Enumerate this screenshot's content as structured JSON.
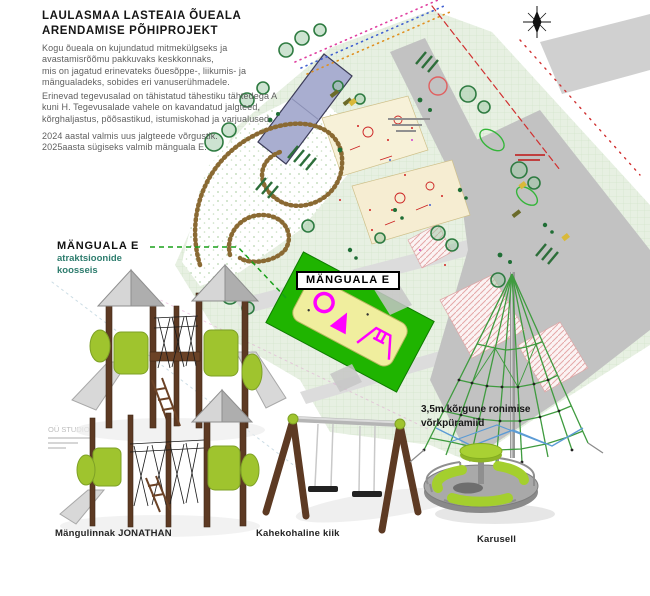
{
  "header": {
    "title": [
      "LAULASMAA LASTEAIA ÕUEALA",
      "ARENDAMISE PÕHIPROJEKT"
    ],
    "paragraph1": [
      "Kogu õueala on kujundatud mitmekülgseks ja",
      "avastamisrõõmu pakkuvaks keskkonnaks,",
      "mis on jagatud erinevateks õuesõppe-, liikumis- ja",
      "mängualadeks, sobides eri vanuserühmadele."
    ],
    "paragraph2": [
      "Erinevad tegevusalad on tähistatud tähestiku tähtedega A",
      "kuni H. Tegevusalade vahele on kavandatud jalgteed,",
      "kõrghaljastus, põõsastikud, istumiskohad ja varjualused."
    ],
    "paragraph3": [
      "2024 aastal valmis uus jalgteede võrgustik.",
      "2025aasta sügiseks valmib mänguala E."
    ]
  },
  "labels": {
    "composition_title": "MÄNGUALA E",
    "composition_sub": [
      "atraktsioonide",
      "koosseis"
    ],
    "map_area": "MÄNGUALA E",
    "pyramid_caption": [
      "3,5m kõrgune ronimise",
      "võrkpüramiid"
    ]
  },
  "captions": {
    "playground_tower": "Mängulinnak JONATHAN",
    "double_swing": "Kahekohaline kiik",
    "carousel": "Karusell"
  },
  "watermark": "OÜ STUDIO",
  "icons": [
    "north-compass-icon"
  ],
  "colors": {
    "highlight_green": "#1fb400",
    "area_yellow": "#f0ee9e",
    "marker_magenta": "#ff00ff",
    "equipment_lime": "#9fc42e",
    "wood_brown": "#5d3a23",
    "accent_teal": "#2e7d6e",
    "road_gray": "#c2c2c2",
    "building_blue": "#a9aed0"
  }
}
